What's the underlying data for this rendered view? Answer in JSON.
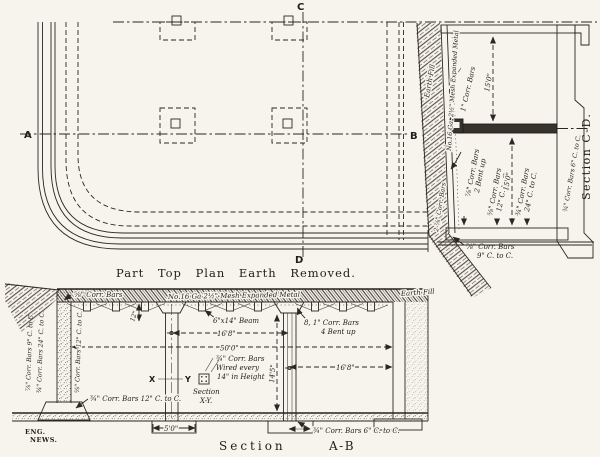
{
  "figure": {
    "credit_line1": "ENG.",
    "credit_line2": "NEWS."
  },
  "plan": {
    "caption": "Part Top Plan Earth Removed.",
    "marker_a": "A",
    "marker_b": "B",
    "marker_c": "C",
    "marker_d": "D"
  },
  "section_cd": {
    "title": "Section C-D.",
    "earth_fill": "Earth Fill",
    "wall_bars": "2-⅞\" Corr. Bars",
    "mesh_note": "No.16 Ga. 2½\" Mesh Expanded Metal",
    "bars_1in": "1\" Corr. Bars",
    "bent_up_line1": "⅞\" Corr. Bars",
    "bent_up_line2": "2 Bent up",
    "bars12_line1": "⅝\" Corr. Bars",
    "bars12_line2": "12\" C. to C.",
    "dim_upper": "15'0\"",
    "dim_lower": "15'0\"",
    "bars24_line1": "¾\" Corr. Bars",
    "bars24_line2": "24\" C. to C.",
    "bars6_wall": "¾\" Corr. Bars 6\" C. to C.",
    "bottom_bars_line1": "⅞\" Corr. Bars",
    "bottom_bars_line2": "9\" C. to C."
  },
  "section_ab": {
    "caption_word": "Section",
    "caption_id": "A-B",
    "earth_fill": "Earth Fill",
    "slab_bars": "⅝\" Corr. Bars",
    "mesh_note": "No.16 Ga 2½\" Mesh Expanded Metal",
    "beam_note": "6\"x14\" Beam",
    "dim_bay1": "16'8\"",
    "dim_total": "50'0\"",
    "dim_bay2": "16'8\"",
    "dim_height": "14'5\"",
    "dim_slab_depth": "12\"",
    "bent_bars_line1": "8, 1\" Corr. Bars",
    "bent_bars_line2": "4 Bent up",
    "wall_bars_9": "⅞\" Corr. Bars 9\" C. to C.",
    "wall_bars_24": "¾\" Corr. Bars 24\" C. to C.",
    "wall_bars_12": "⅝\" Corr. Bars 12\" C. to C.",
    "floor_bars_12": "¾\" Corr. Bars 12\" C. to C.",
    "floor_bars_6": "¾\" Corr. Bars 6\" C. to C.",
    "col_cut_x": "X",
    "col_cut_y": "Y",
    "col_note_line1": "¾\" Corr. Bars",
    "col_note_line2": "Wired every",
    "col_note_line3": "14\" in Height",
    "sec_xy_line1": "Section",
    "sec_xy_line2": "X-Y.",
    "dim_footing": "5'0\""
  }
}
